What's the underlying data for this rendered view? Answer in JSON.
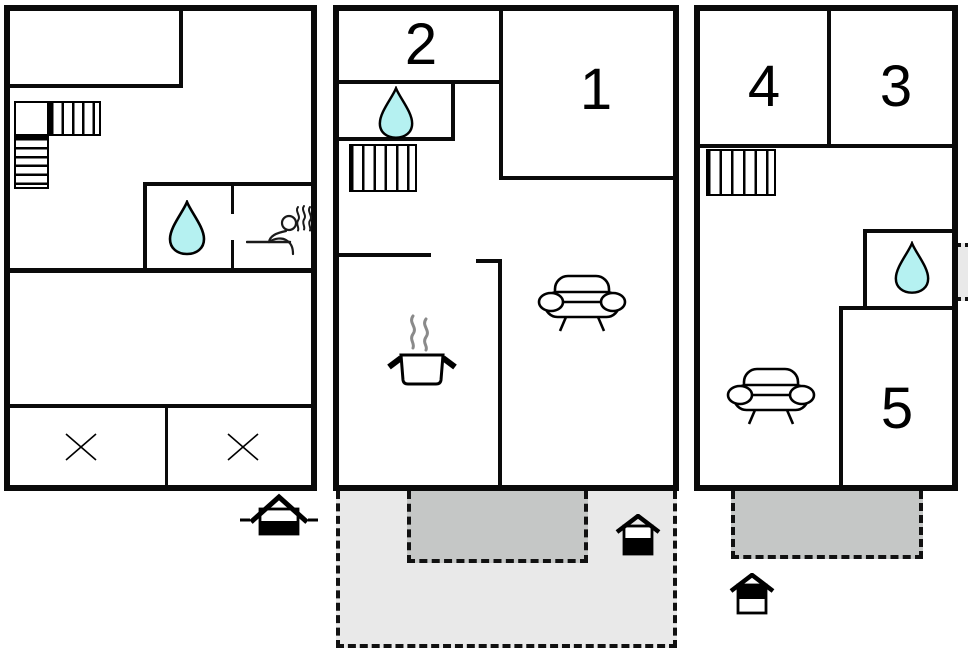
{
  "title": "holiday-home-floor-plan",
  "colors": {
    "wall": "#0a0a0a",
    "background": "#ffffff",
    "water_drop": "#b5f1f1",
    "terrace_light": "#e9e9e9",
    "terrace_dark": "#c5c7c6",
    "steam_gray": "#8a8a8a"
  },
  "room_labels": {
    "r1": "1",
    "r2": "2",
    "r3": "3",
    "r4": "4",
    "r5": "5"
  },
  "floors": [
    {
      "name": "left-floor",
      "features": [
        "l-shaped-staircase",
        "bathroom-with-water-drop",
        "sauna",
        "crossed-room",
        "crossed-room"
      ],
      "entrance": "house-marker-with-side-dashes"
    },
    {
      "name": "middle-floor",
      "rooms": [
        "2",
        "1"
      ],
      "features": [
        "bathroom-with-water-drop",
        "staircase",
        "kitchen-pot",
        "sofa"
      ],
      "terraces": [
        "light-gray-dashed-terrace",
        "dark-gray-dashed-terrace"
      ],
      "entrance": "house-marker"
    },
    {
      "name": "right-floor",
      "rooms": [
        "4",
        "3",
        "5"
      ],
      "features": [
        "staircase",
        "bathroom-with-water-drop",
        "sofa",
        "edge-balcony-marker"
      ],
      "terraces": [
        "dark-gray-dashed-terrace"
      ],
      "entrance": "house-marker"
    }
  ]
}
